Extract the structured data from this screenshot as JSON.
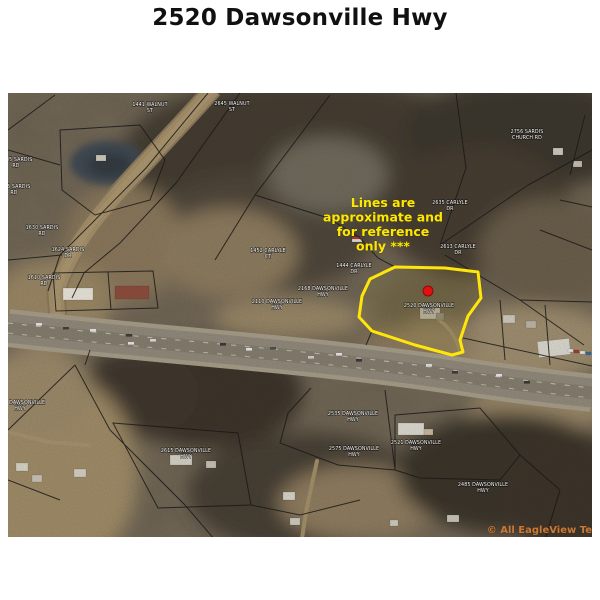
{
  "page": {
    "title": "2520 Dawsonville Hwy"
  },
  "map": {
    "disclaimer": {
      "lines": [
        "Lines are",
        "approximate and",
        "for reference",
        "only ***"
      ],
      "color": "#ffe800",
      "x": 375,
      "y": 114,
      "line_height": 14.5
    },
    "subject_parcel": {
      "address": "2520 Dawsonville Hwy",
      "outline_color": "#ffe60a",
      "marker_color": "#e01111"
    },
    "watermark": {
      "text": "© All EagleView Te",
      "color": "#c87a3b"
    },
    "parcel_labels": [
      {
        "lines": [
          "1441 WALNUT",
          "ST"
        ],
        "x": 142,
        "y": 13
      },
      {
        "lines": [
          "2645 WALNUT",
          "ST"
        ],
        "x": 224,
        "y": 12
      },
      {
        "lines": [
          "2756 SARDIS",
          "CHURCH RD"
        ],
        "x": 519,
        "y": 40
      },
      {
        "lines": [
          "1685 SARDIS",
          "RD"
        ],
        "x": 8,
        "y": 68
      },
      {
        "lines": [
          "1675 SARDIS",
          "RD"
        ],
        "x": 6,
        "y": 95
      },
      {
        "lines": [
          "1630 SARDIS",
          "RD"
        ],
        "x": 34,
        "y": 136
      },
      {
        "lines": [
          "1624 SARDIS",
          "DR"
        ],
        "x": 60,
        "y": 158
      },
      {
        "lines": [
          "1610 SARDIS",
          "RD"
        ],
        "x": 36,
        "y": 186
      },
      {
        "lines": [
          "2635 CARLYLE",
          "DR"
        ],
        "x": 442,
        "y": 111
      },
      {
        "lines": [
          "2613 CARLYLE",
          "DR"
        ],
        "x": 450,
        "y": 155
      },
      {
        "lines": [
          "1444 CARLYLE",
          "DR"
        ],
        "x": 346,
        "y": 174
      },
      {
        "lines": [
          "1452 CARLYLE",
          "CT"
        ],
        "x": 260,
        "y": 159
      },
      {
        "lines": [
          "2168 DAWSONVILLE",
          "HWY"
        ],
        "x": 315,
        "y": 197
      },
      {
        "lines": [
          "2110 DAWSONVILLE",
          "HWY"
        ],
        "x": 269,
        "y": 210
      },
      {
        "lines": [
          "2520 DAWSONVILLE",
          "HWY"
        ],
        "x": 421,
        "y": 214
      },
      {
        "lines": [
          "2535 DAWSONVILLE",
          "HWY"
        ],
        "x": 345,
        "y": 322
      },
      {
        "lines": [
          "2575 DAWSONVILLE",
          "HWY"
        ],
        "x": 346,
        "y": 357
      },
      {
        "lines": [
          "2521 DAWSONVILLE",
          "HWY"
        ],
        "x": 408,
        "y": 351
      },
      {
        "lines": [
          "2615 DAWSONVILLE",
          "HWY"
        ],
        "x": 178,
        "y": 359
      },
      {
        "lines": [
          "2485 DAWSONVILLE",
          "HWY"
        ],
        "x": 475,
        "y": 393
      },
      {
        "lines": [
          "2685 DAWSONVILLE",
          "HWY"
        ],
        "x": 12,
        "y": 311
      }
    ]
  }
}
